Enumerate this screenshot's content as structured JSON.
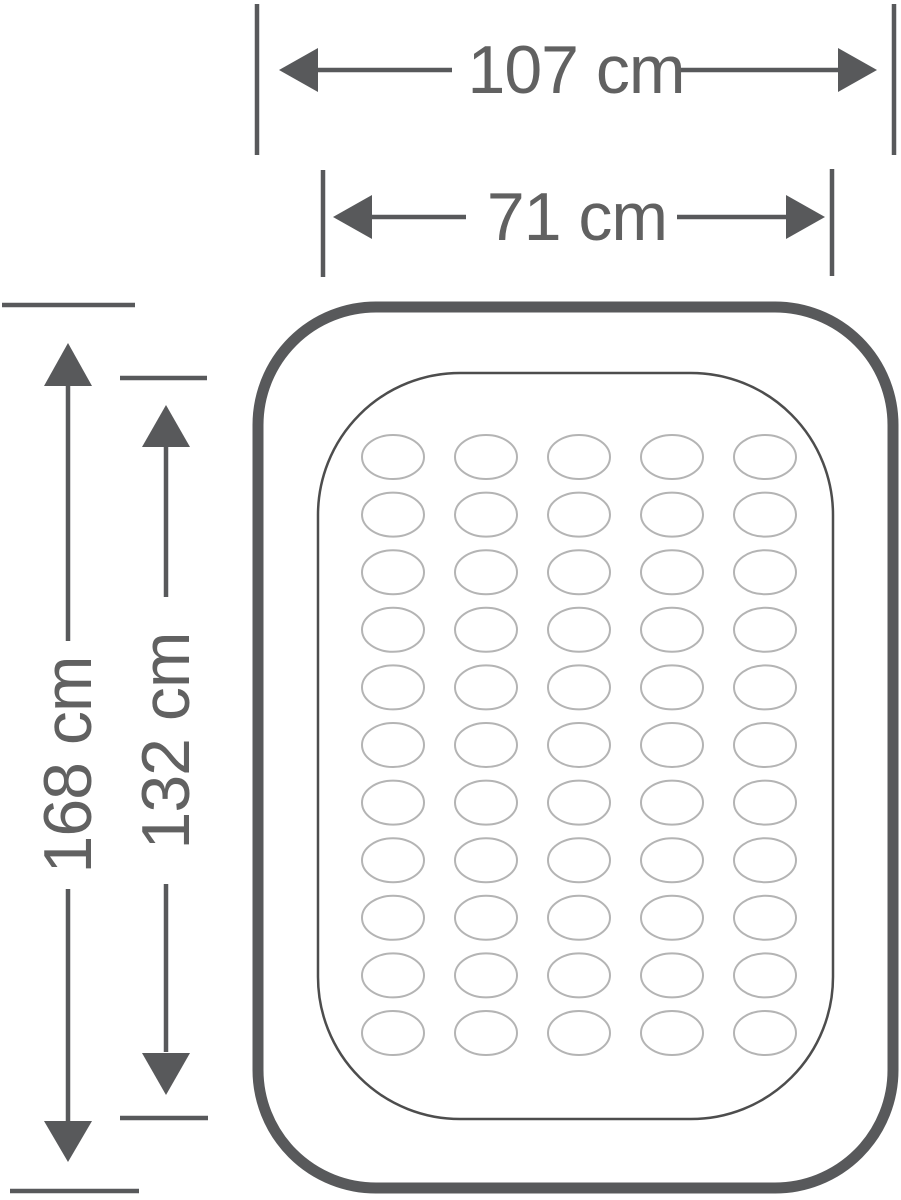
{
  "diagram": {
    "dimensions": {
      "outer_width": "107 cm",
      "inner_width": "71 cm",
      "outer_length": "168 cm",
      "inner_length": "132 cm"
    },
    "coil_grid": {
      "columns": 5,
      "rows": 11
    },
    "colors": {
      "dimension_line": "#58595b",
      "dimension_text": "#616161",
      "mattress_outline": "#58595b",
      "sleep_surface_outline": "#4d4d4d",
      "coil_stroke": "#b4b4b4",
      "background": "#ffffff"
    }
  }
}
